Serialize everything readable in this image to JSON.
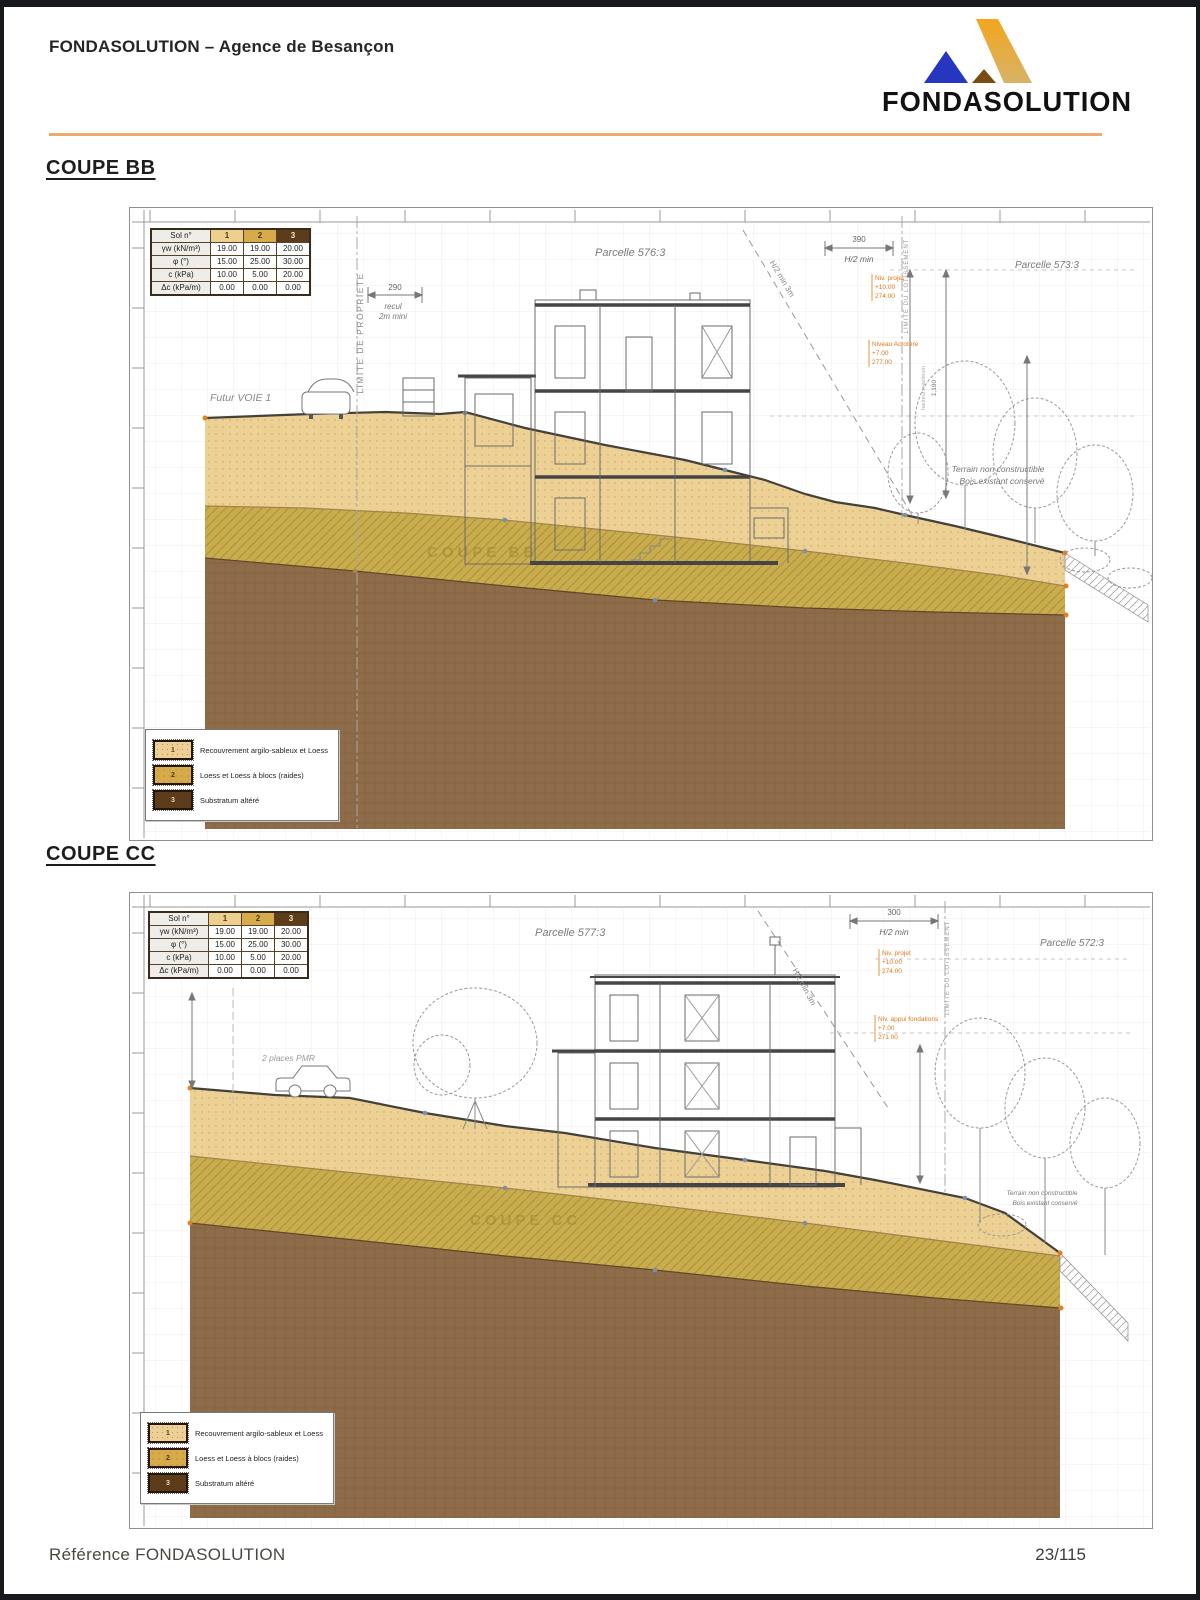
{
  "page": {
    "header_title": "FONDASOLUTION – Agence de Besançon",
    "logo_text": "FONDASOLUTION",
    "logo_icon": "fondasolution-triangles-logo",
    "footer_left": "Référence FONDASOLUTION",
    "footer_right": "23/115"
  },
  "colors": {
    "accent_rule": "#ECAA6D",
    "soil_1": "#EDD094",
    "soil_2": "#C9AC4E",
    "soil_3": "#8F6C49",
    "annotation_orange": "#E07818",
    "logo_orange": "#E89125",
    "logo_blue": "#2636BF"
  },
  "soil_table": {
    "col_headers": [
      "Sol n°",
      "1",
      "2",
      "3"
    ],
    "rows": [
      {
        "label": "γw (kN/m³)",
        "v1": "19.00",
        "v2": "19.00",
        "v3": "20.00"
      },
      {
        "label": "φ (°)",
        "v1": "15.00",
        "v2": "25.00",
        "v3": "30.00"
      },
      {
        "label": "c (kPa)",
        "v1": "10.00",
        "v2": "5.00",
        "v3": "20.00"
      },
      {
        "label": "Δc (kPa/m)",
        "v1": "0.00",
        "v2": "0.00",
        "v3": "0.00"
      }
    ]
  },
  "legend": {
    "items": [
      {
        "num": "1",
        "label": "Recouvrement argilo-sableux et Loess"
      },
      {
        "num": "2",
        "label": "Loess et Loess à blocs (raides)"
      },
      {
        "num": "3",
        "label": "Substratum altéré"
      }
    ]
  },
  "coupe_bb": {
    "heading": "COUPE BB",
    "watermark": "COUPE BB",
    "parcelle_left": "Parcelle 576:3",
    "parcelle_right": "Parcelle 573:3",
    "limite_propriete": "LIMITE DE PROPRIETE",
    "limite_lotissement": "LIMITE DU LOTISSEMENT",
    "recul_dim": "290",
    "recul_word1": "recul",
    "recul_word2": "2m mini",
    "h2_dim": "390",
    "h2_label": "H/2 min",
    "diag_label": "H/2 min 3m",
    "futur_voie": "Futur VOIE 1",
    "terrain_line1": "Terrain non constructible",
    "terrain_line2": "Bois existant conservé",
    "height_dim": "1,190",
    "height_label": "hauteur maximum",
    "ann1": [
      "Niv. projet",
      "+10.00",
      "274.00"
    ],
    "ann2": [
      "Niveau Acrotère",
      "+7.00",
      "277.00"
    ]
  },
  "coupe_cc": {
    "heading": "COUPE CC",
    "watermark": "COUPE CC",
    "parcelle_left": "Parcelle 577:3",
    "parcelle_right": "Parcelle 572:3",
    "limite_lotissement": "LIMITE DU LOTISSEMENT",
    "h2_dim": "300",
    "h2_label": "H/2 min",
    "diag_label": "H/2 min 3m",
    "pmr_label": "2 places PMR",
    "terrain_line1": "Terrain non constructible",
    "terrain_line2": "Bois existant conservé",
    "ann1": [
      "Niv. projet",
      "+10.00",
      "274.00"
    ],
    "ann2": [
      "Niv. appui fondations",
      "+7.00",
      "271.00"
    ]
  }
}
